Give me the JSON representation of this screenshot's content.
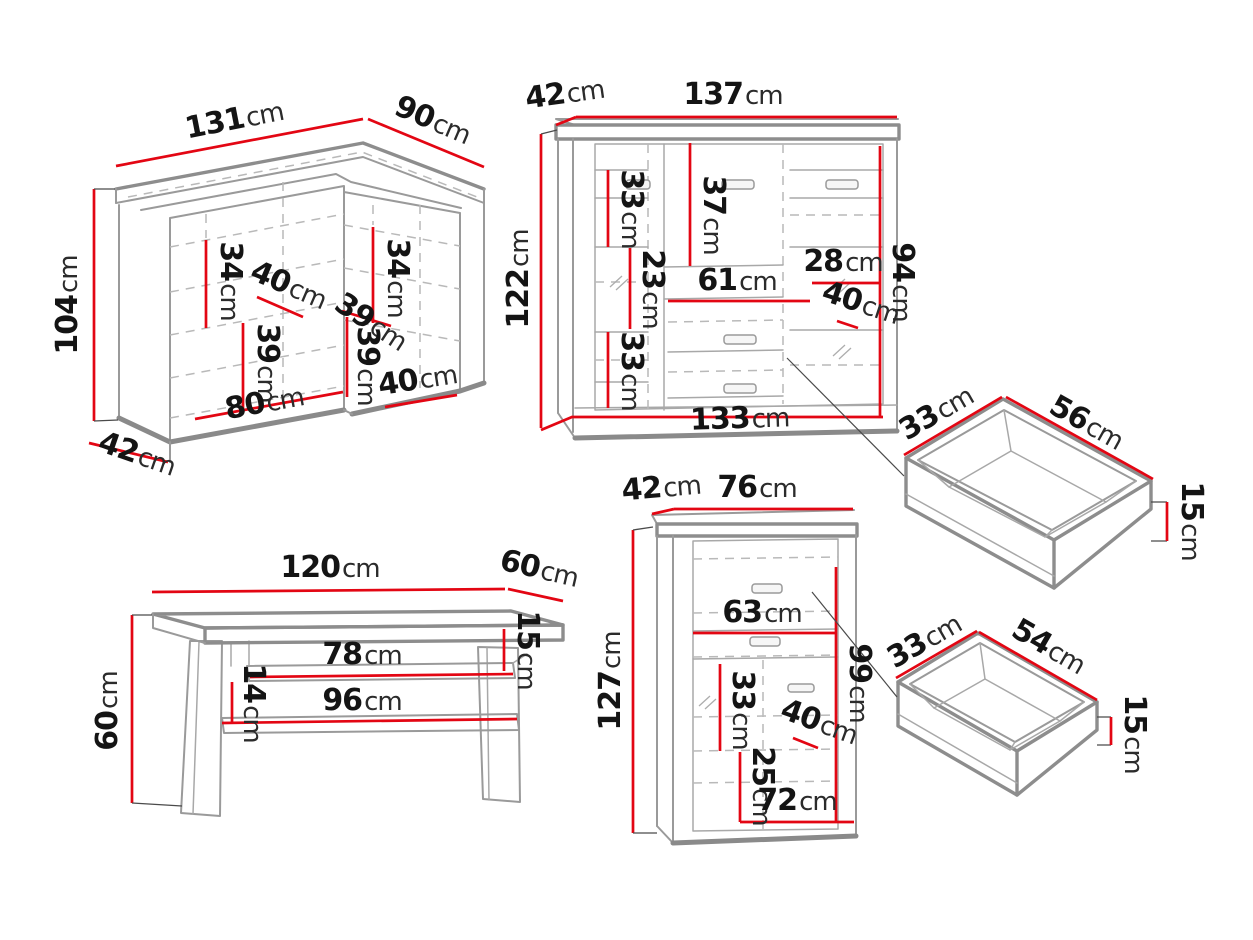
{
  "diagram": {
    "unit": "cm",
    "background": "#ffffff",
    "colors": {
      "dimension_line": "#e30613",
      "furniture_outline": "#8d8d8d",
      "hidden_line": "#b9b9b9",
      "label_text": "#141414",
      "leader_line": "#4a4a4a"
    },
    "pieces": {
      "corner_cabinet": {
        "name": "corner cabinet",
        "dims": {
          "top_width": "131",
          "top_depth": "90",
          "height": "104",
          "left_shelf": "34",
          "right_shelf": "34",
          "inner_width": "40",
          "shelf_diagonal": "39",
          "center_shelf": "39",
          "right_lower_shelf": "39",
          "bottom_right_width": "40",
          "bottom_width": "80",
          "base_depth": "42"
        }
      },
      "sideboard": {
        "name": "sideboard",
        "dims": {
          "depth": "42",
          "width": "137",
          "height": "122",
          "upper_left_shelf": "33",
          "door_height": "37",
          "mid_left_shelf": "23",
          "drawer_width": "61",
          "right_shelf": "28",
          "inner_height": "94",
          "inner_depth": "40",
          "lower_left_shelf": "33",
          "base_width": "133"
        }
      },
      "drawer_large": {
        "name": "drawer",
        "dims": {
          "depth": "33",
          "width": "56",
          "height": "15"
        }
      },
      "drawer_small": {
        "name": "drawer",
        "dims": {
          "depth": "33",
          "width": "54",
          "height": "15"
        }
      },
      "coffee_table": {
        "name": "coffee table",
        "dims": {
          "top_width": "120",
          "top_depth": "60",
          "height": "60",
          "top_gap": "15",
          "shelf_width": "78",
          "shelf_gap": "14",
          "lower_shelf_width": "96"
        }
      },
      "cabinet": {
        "name": "highboard cabinet",
        "dims": {
          "depth": "42",
          "width": "76",
          "height": "127",
          "drawer_width": "63",
          "inner_height": "99",
          "shelf": "33",
          "inner_depth": "40",
          "lower_shelf": "25",
          "base_width": "72"
        }
      }
    }
  }
}
